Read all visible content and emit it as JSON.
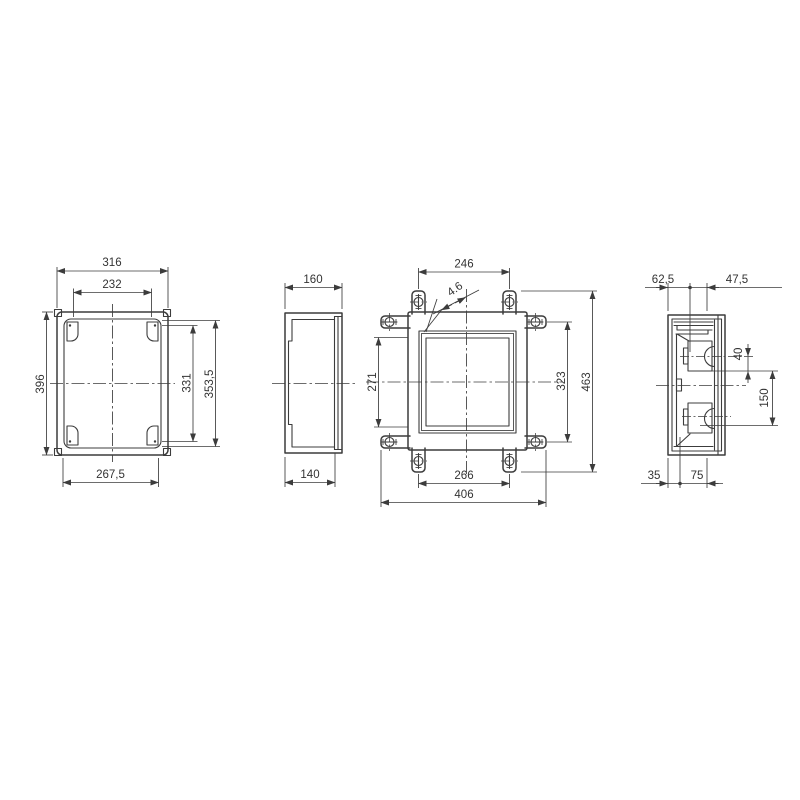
{
  "drawing": {
    "type": "technical-enclosure-drawing",
    "background": "#ffffff",
    "line_color": "#3c3c3c",
    "views": {
      "front": {
        "dim_width_outer": "316",
        "dim_width_inner": "232",
        "dim_height_outer": "396",
        "dim_height_inner": "331",
        "dim_height_recess": "353,5",
        "dim_width_bottom": "267,5"
      },
      "side": {
        "dim_depth_outer": "160",
        "dim_depth_body": "140"
      },
      "back": {
        "dim_fix_top": "246",
        "dim_hole_dia": "4.6",
        "dim_left_opening": "271",
        "dim_fix_right": "323",
        "dim_height_total": "463",
        "dim_fix_bottom": "266",
        "dim_width_total": "406"
      },
      "section": {
        "dim_top_a": "62,5",
        "dim_top_b": "47,5",
        "dim_rail_offset": "40",
        "dim_rail_span": "150",
        "dim_bottom_a": "35",
        "dim_bottom_b": "75"
      }
    }
  }
}
